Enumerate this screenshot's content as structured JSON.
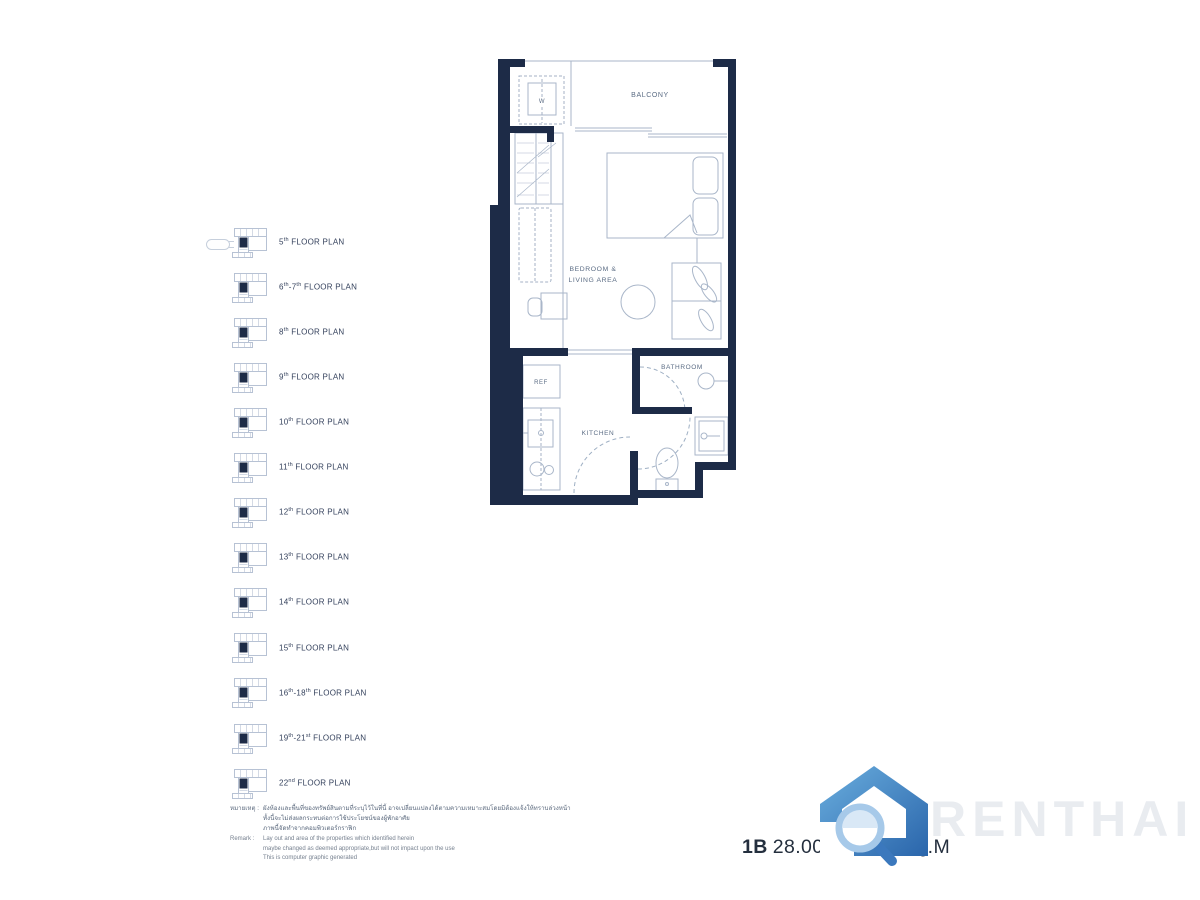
{
  "unit_summary": {
    "type": "1B",
    "area_range": "28.00 - 29.00 SQ.M"
  },
  "watermark": {
    "brand": "RENTHAI"
  },
  "unit_plan": {
    "room_labels": {
      "balcony": "BALCONY",
      "washer": "W",
      "bedroom_line1": "BEDROOM &",
      "bedroom_line2": "LIVING AREA",
      "bathroom": "BATHROOM",
      "kitchen": "KITCHEN",
      "fridge": "REF"
    }
  },
  "floor_plan_list": {
    "items": [
      {
        "label": "5th FLOOR PLAN",
        "has_podium_extension": true
      },
      {
        "label": "6th-7th FLOOR PLAN",
        "has_podium_extension": false
      },
      {
        "label": "8th FLOOR PLAN",
        "has_podium_extension": false
      },
      {
        "label": "9th FLOOR PLAN",
        "has_podium_extension": false
      },
      {
        "label": "10th FLOOR PLAN",
        "has_podium_extension": false
      },
      {
        "label": "11th FLOOR PLAN",
        "has_podium_extension": false
      },
      {
        "label": "12th FLOOR PLAN",
        "has_podium_extension": false
      },
      {
        "label": "13th FLOOR PLAN",
        "has_podium_extension": false
      },
      {
        "label": "14th FLOOR PLAN",
        "has_podium_extension": false
      },
      {
        "label": "15th FLOOR PLAN",
        "has_podium_extension": false
      },
      {
        "label": "16th-18th FLOOR PLAN",
        "has_podium_extension": false
      },
      {
        "label": "19th-21st FLOOR PLAN",
        "has_podium_extension": false
      },
      {
        "label": "22nd FLOOR PLAN",
        "has_podium_extension": false
      }
    ]
  },
  "remarks": {
    "thai_prefix": "หมายเหตุ :",
    "thai_lines": [
      "ผังห้องและพื้นที่ของทรัพย์สินตามที่ระบุไว้ในที่นี้ อาจเปลี่ยนแปลงได้ตามความเหมาะสมโดยมิต้องแจ้งให้ทราบล่วงหน้า",
      "ทั้งนี้จะไม่ส่งผลกระทบต่อการใช้ประโยชน์ของผู้พักอาศัย",
      "ภาพนี้จัดทำจากคอมพิวเตอร์กราฟิก"
    ],
    "en_prefix": "Remark :",
    "en_lines": [
      "Lay out and area of the properties which identified herein",
      "maybe changed as deemed appropriate,but will not impact upon the use",
      "This is computer graphic generated"
    ]
  },
  "colors": {
    "wall_navy": "#1d2b47",
    "plan_line": "#a9b6c9",
    "label_text": "#5b6c84",
    "sidebar_text": "#34415c",
    "logo_blue_light": "#6aaede",
    "logo_blue_dark": "#2a65ab",
    "watermark_text": "#e9ecf0"
  }
}
